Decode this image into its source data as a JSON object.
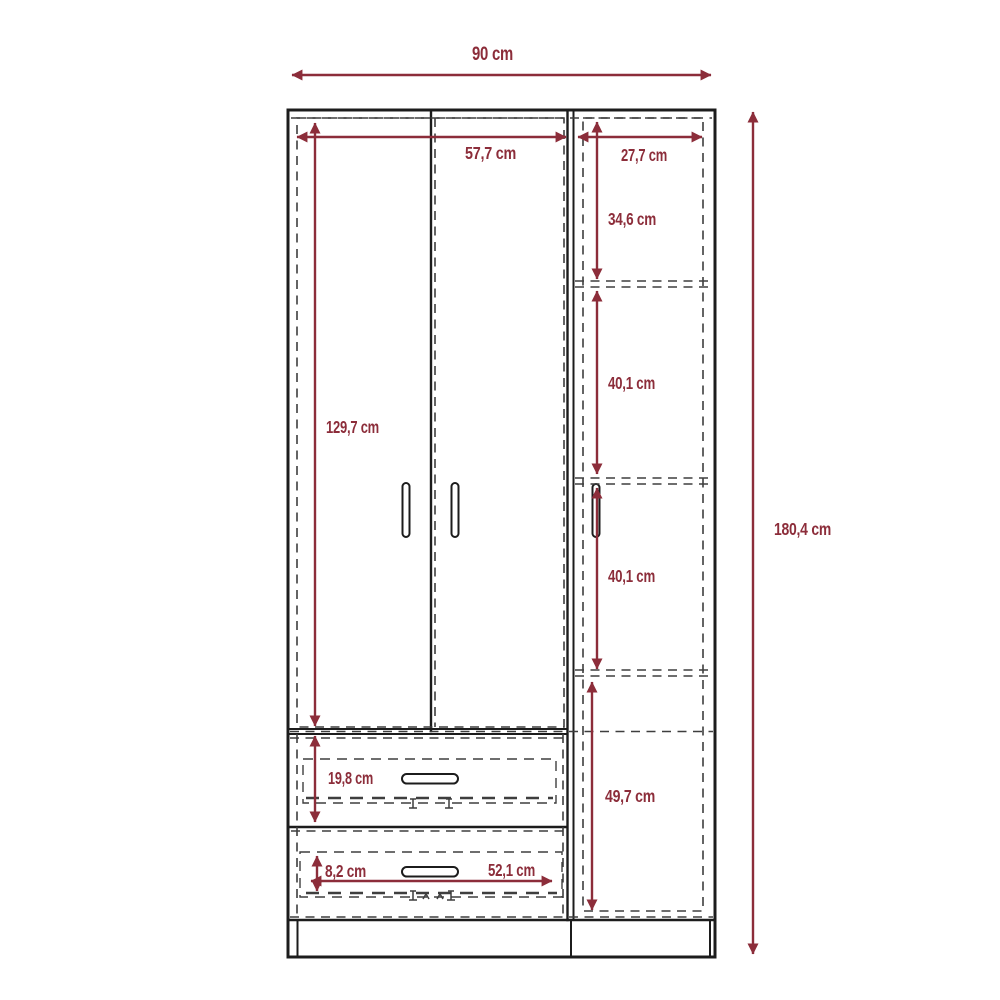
{
  "diagram_title": "wardrobe-dimension-drawing",
  "colors": {
    "background": "#ffffff",
    "outline": "#1c1c1c",
    "hidden_line": "#3e3e3e",
    "dimension": "#8c2d3a"
  },
  "dimensions": {
    "overall_width": "90 cm",
    "overall_height": "180,4 cm",
    "left_section_inner_width": "57,7 cm",
    "right_section_inner_width": "27,7 cm",
    "door_inner_height": "129,7 cm",
    "right_top_compartment_height": "34,6 cm",
    "right_middle_compartment_height": "40,1 cm",
    "right_lower_compartment_height": "40,1 cm",
    "right_bottom_compartment_height": "49,7 cm",
    "top_drawer_height": "19,8 cm",
    "bottom_drawer_inner_height": "8,2 cm",
    "bottom_drawer_inner_width": "52,1 cm"
  }
}
